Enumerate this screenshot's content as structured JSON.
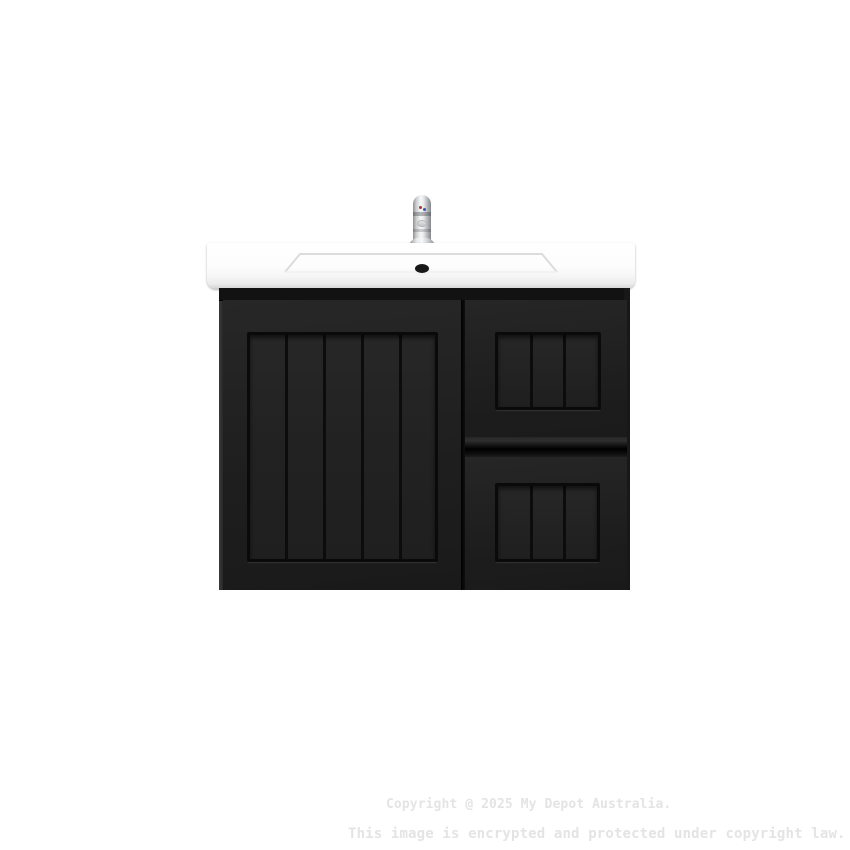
{
  "image": {
    "type": "product-photo",
    "subject": "Black wall-hung bathroom vanity with left V-groove door, two right drawers, white ceramic basin top and chrome mixer tap",
    "background_color": "#ffffff"
  },
  "watermark": {
    "line1": "Copyright @ 2025 My Depot Australia.",
    "line2": "This image is encrypted and protected under copyright law.",
    "color": "#e4e4e4"
  },
  "colors": {
    "cabinet_black": "#181818",
    "panel_face": "#232323",
    "groove_black": "#0b0b0b",
    "basin_white": "#fdfdfd",
    "basin_edge_shadow": "#c2c2c2",
    "chrome_light": "#f6f7f8",
    "chrome_dark": "#8f9296",
    "hot_indicator_red": "#b03232",
    "cold_indicator_blue": "#3a57a8"
  }
}
